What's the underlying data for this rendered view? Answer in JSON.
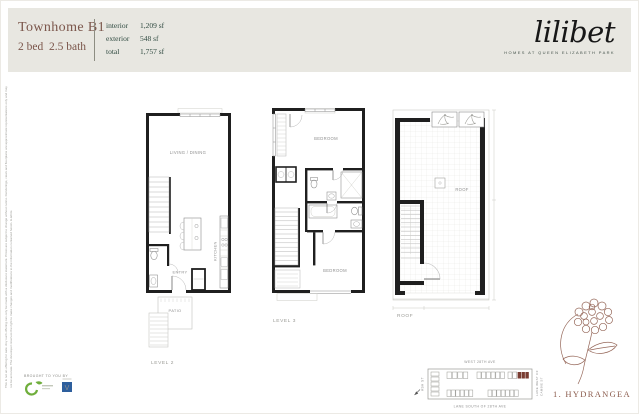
{
  "header": {
    "title": "Townhome B1",
    "subtitle": "2 bed  2.5 bath",
    "specs": {
      "rows": [
        {
          "label": "interior",
          "value": "1,209 sf"
        },
        {
          "label": "exterior",
          "value": "548 sf"
        },
        {
          "label": "total",
          "value": "1,757 sf"
        }
      ]
    },
    "brand": {
      "wordmark": "lilibet",
      "tagline": "HOMES AT QUEEN ELIZABETH PARK"
    }
  },
  "plans": {
    "level2": {
      "label": "LEVEL 2",
      "living": "LIVING / DINING",
      "kitchen": "KITCHEN",
      "entry": "ENTRY",
      "patio": "PATIO"
    },
    "level3": {
      "label": "LEVEL 3",
      "bedroom_top": "BEDROOM",
      "bedroom_bottom": "BEDROOM"
    },
    "roof": {
      "label": "ROOF",
      "deck": "ROOF"
    }
  },
  "sitemap": {
    "street_top": "WEST 28TH AVE",
    "street_bottom": "LANE SOUTH OF 28TH AVE",
    "street_left": "ASH ST",
    "street_right_line1": "LANE WEST OF",
    "street_right_line2": "CAMBIE ST",
    "highlight_color": "#7a3d32"
  },
  "flower": {
    "label": "1. HYDRANGEA",
    "color": "#96685a"
  },
  "footer": {
    "brought": "BROUGHT TO YOU BY",
    "logo_v": "V"
  },
  "colors": {
    "accent_maroon": "#7b564b",
    "accent_green": "#2e493f",
    "band": "#e8e7e1"
  },
  "disclaimer": "This is not an offering for sale. Any such offering can only be made with a disclosure statement. Prices are subject to change without notice. Renderings, views and floorplans are approximate representations only and may not be accurate. The developer reserves the right to make changes and modifications to the information contained herein. E.&O.E."
}
